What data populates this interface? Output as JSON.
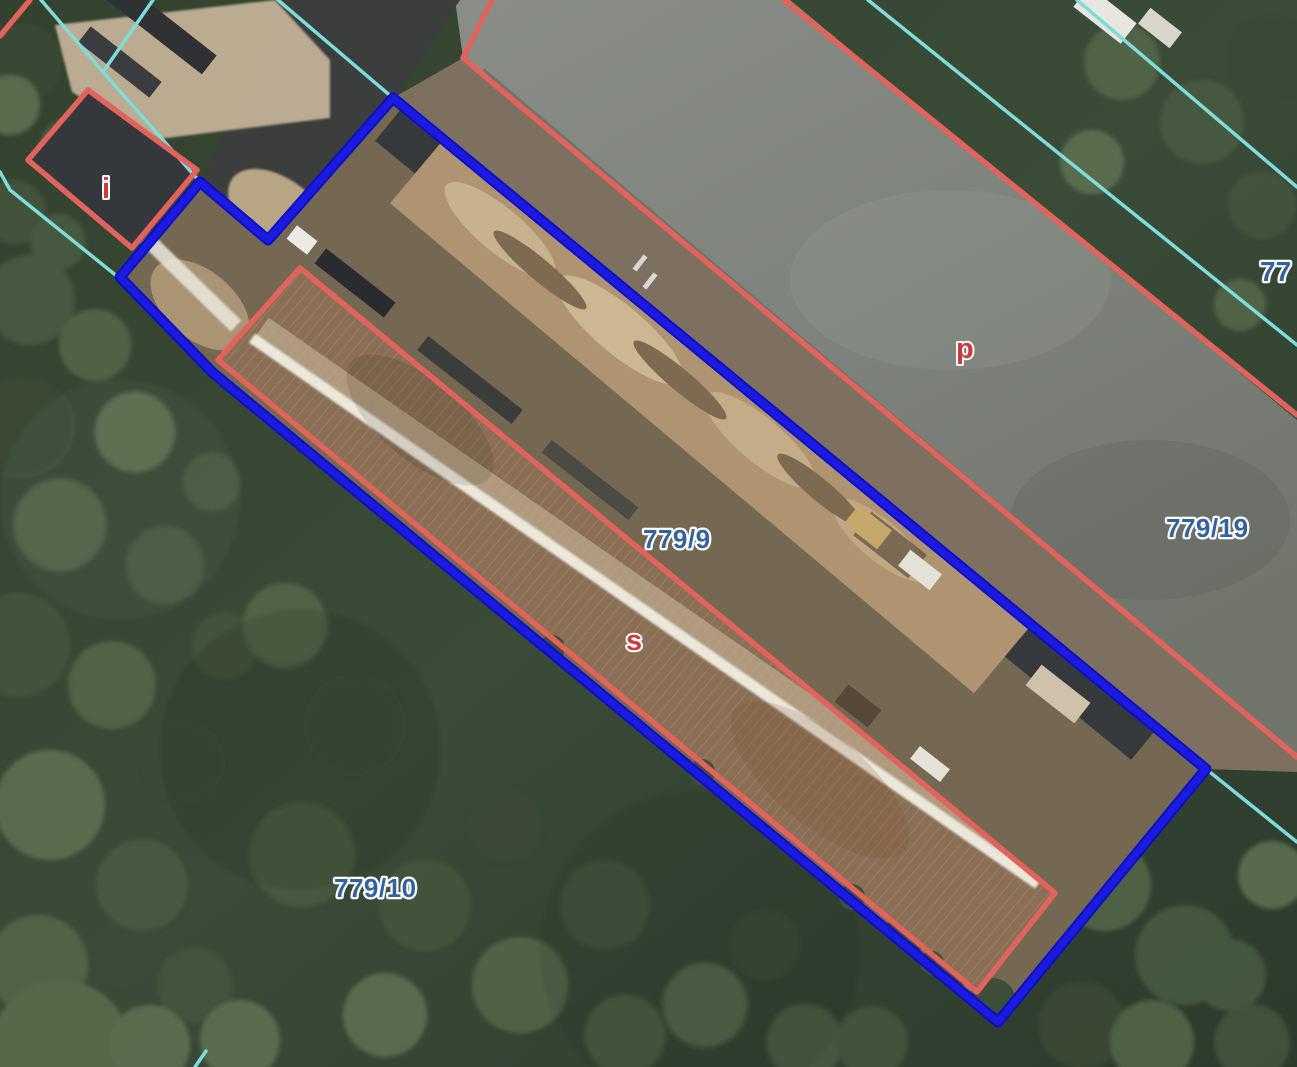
{
  "map": {
    "type_note": "aerial cadastral map view",
    "parcel_labels": [
      {
        "id": "779-9",
        "text": "779/9"
      },
      {
        "id": "779-19",
        "text": "779/19"
      },
      {
        "id": "779-10",
        "text": "779/10"
      },
      {
        "id": "77-clipped",
        "text": "77"
      }
    ],
    "land_use_labels": [
      {
        "id": "i",
        "text": "i"
      },
      {
        "id": "p",
        "text": "p"
      },
      {
        "id": "s",
        "text": "s"
      }
    ],
    "colors": {
      "selection_outline": "#1b1be0",
      "selection_outline_dark": "#0e0ec2",
      "parcel_boundary_red": "#e2635c",
      "boundary_cyan": "#7eddda",
      "parcel_label_blue": "#33639f",
      "land_use_label_red": "#cc3a3a"
    }
  }
}
